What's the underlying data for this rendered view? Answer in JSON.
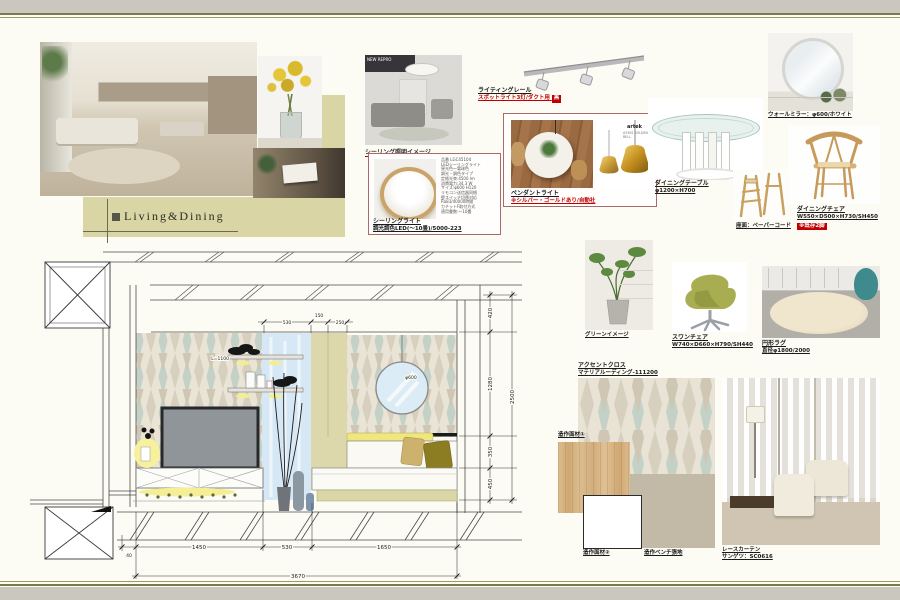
{
  "board": {
    "title": "Living&Dining"
  },
  "lighting": {
    "ceiling_room_brand": "NEW REPRO",
    "ceiling_image_caption": "シーリング照明イメージ",
    "ceiling_name": "シーリングライト",
    "ceiling_spec": "調光調色LED(〜10畳)/5000-223",
    "ceiling_details": [
      "品番 LGC45104",
      "LEDシーリングライト",
      "昼光色〜電球色",
      "調光・調色タイプ",
      "定格光束:4500 lm",
      "消費電力:34.3 W",
      "サイズ:φ600 H120",
      "リモコン送信器同梱",
      "壁スイッチ切替対応",
      "Ra83/40000時間",
      "カチットF取付方式",
      "適用畳数:〜10畳"
    ],
    "rail_name": "ライティングレール",
    "rail_note": "スポットライト3灯/ダクト用",
    "rail_badge": "黒",
    "pendant_name": "ペンダントライト",
    "pendant_note": "※シルバー・ゴールドあり/自動社",
    "pendant_brand": "artek",
    "pendant_model": "A330S GOLDEN BELL"
  },
  "furniture": {
    "table_name": "ダイニングテーブル",
    "table_spec": "φ1200×H700",
    "mirror_name": "ウォールミラー：φ600/ホワイト",
    "chair_name": "ダイニングチェア",
    "chair_spec": "W550×D500×H730/SH450",
    "chair_badge": "※既存2脚",
    "stool_name": "座面：ペーパーコード",
    "green_name": "グリーンイメージ",
    "swan_name": "スワンチェア",
    "swan_spec": "W740×D660×H790/SH440",
    "rug_name": "円形ラグ",
    "rug_spec": "直径φ1800/2000"
  },
  "materials": {
    "accent_name": "アクセントクロス",
    "accent_spec": "マテリアルーディング-111200",
    "material1": "造作面材①",
    "material2": "造作面材②",
    "bench_fabric": "造作ベンチ張地",
    "curtain_name": "レースカーテン",
    "curtain_spec": "サンゲツ：SC0616"
  },
  "drawing": {
    "shelf_label": "L=1100",
    "mirror_dia": "φ600",
    "dims_top": [
      "530",
      "150",
      "250"
    ],
    "dims_right": [
      "420",
      "1280",
      "350",
      "450"
    ],
    "dim_right_total": "2500",
    "dims_bottom": [
      "40",
      "1450",
      "530",
      "1650"
    ],
    "dim_bottom_total": "3670"
  },
  "colors": {
    "accent_khaki": "#d9d5a4",
    "band_gray": "#cac7be",
    "line_olive": "#7a7a4c",
    "red_note": "#c00000"
  }
}
